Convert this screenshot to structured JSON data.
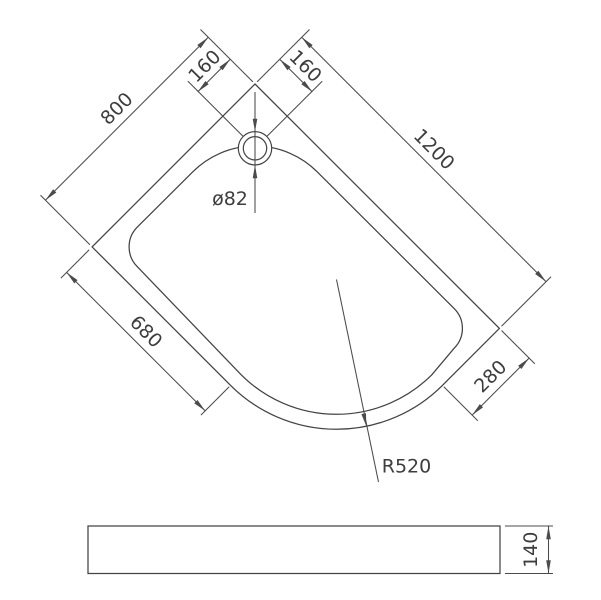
{
  "drawing": {
    "kind": "technical-drawing",
    "subject": "offset quadrant shower tray",
    "colors": {
      "line": "#4b4b4b",
      "outline": "#434343",
      "text": "#3d3d3d",
      "background": "#ffffff"
    },
    "plan_view": {
      "dim_width_left": "800",
      "dim_length_right": "1200",
      "dim_drain_offset_left": "160",
      "dim_drain_offset_right": "160",
      "dim_straight_lower_left": "680",
      "dim_straight_lower_right": "280",
      "dim_drain_diameter": "ø82",
      "dim_front_radius": "R520"
    },
    "side_view": {
      "dim_height": "140"
    }
  }
}
